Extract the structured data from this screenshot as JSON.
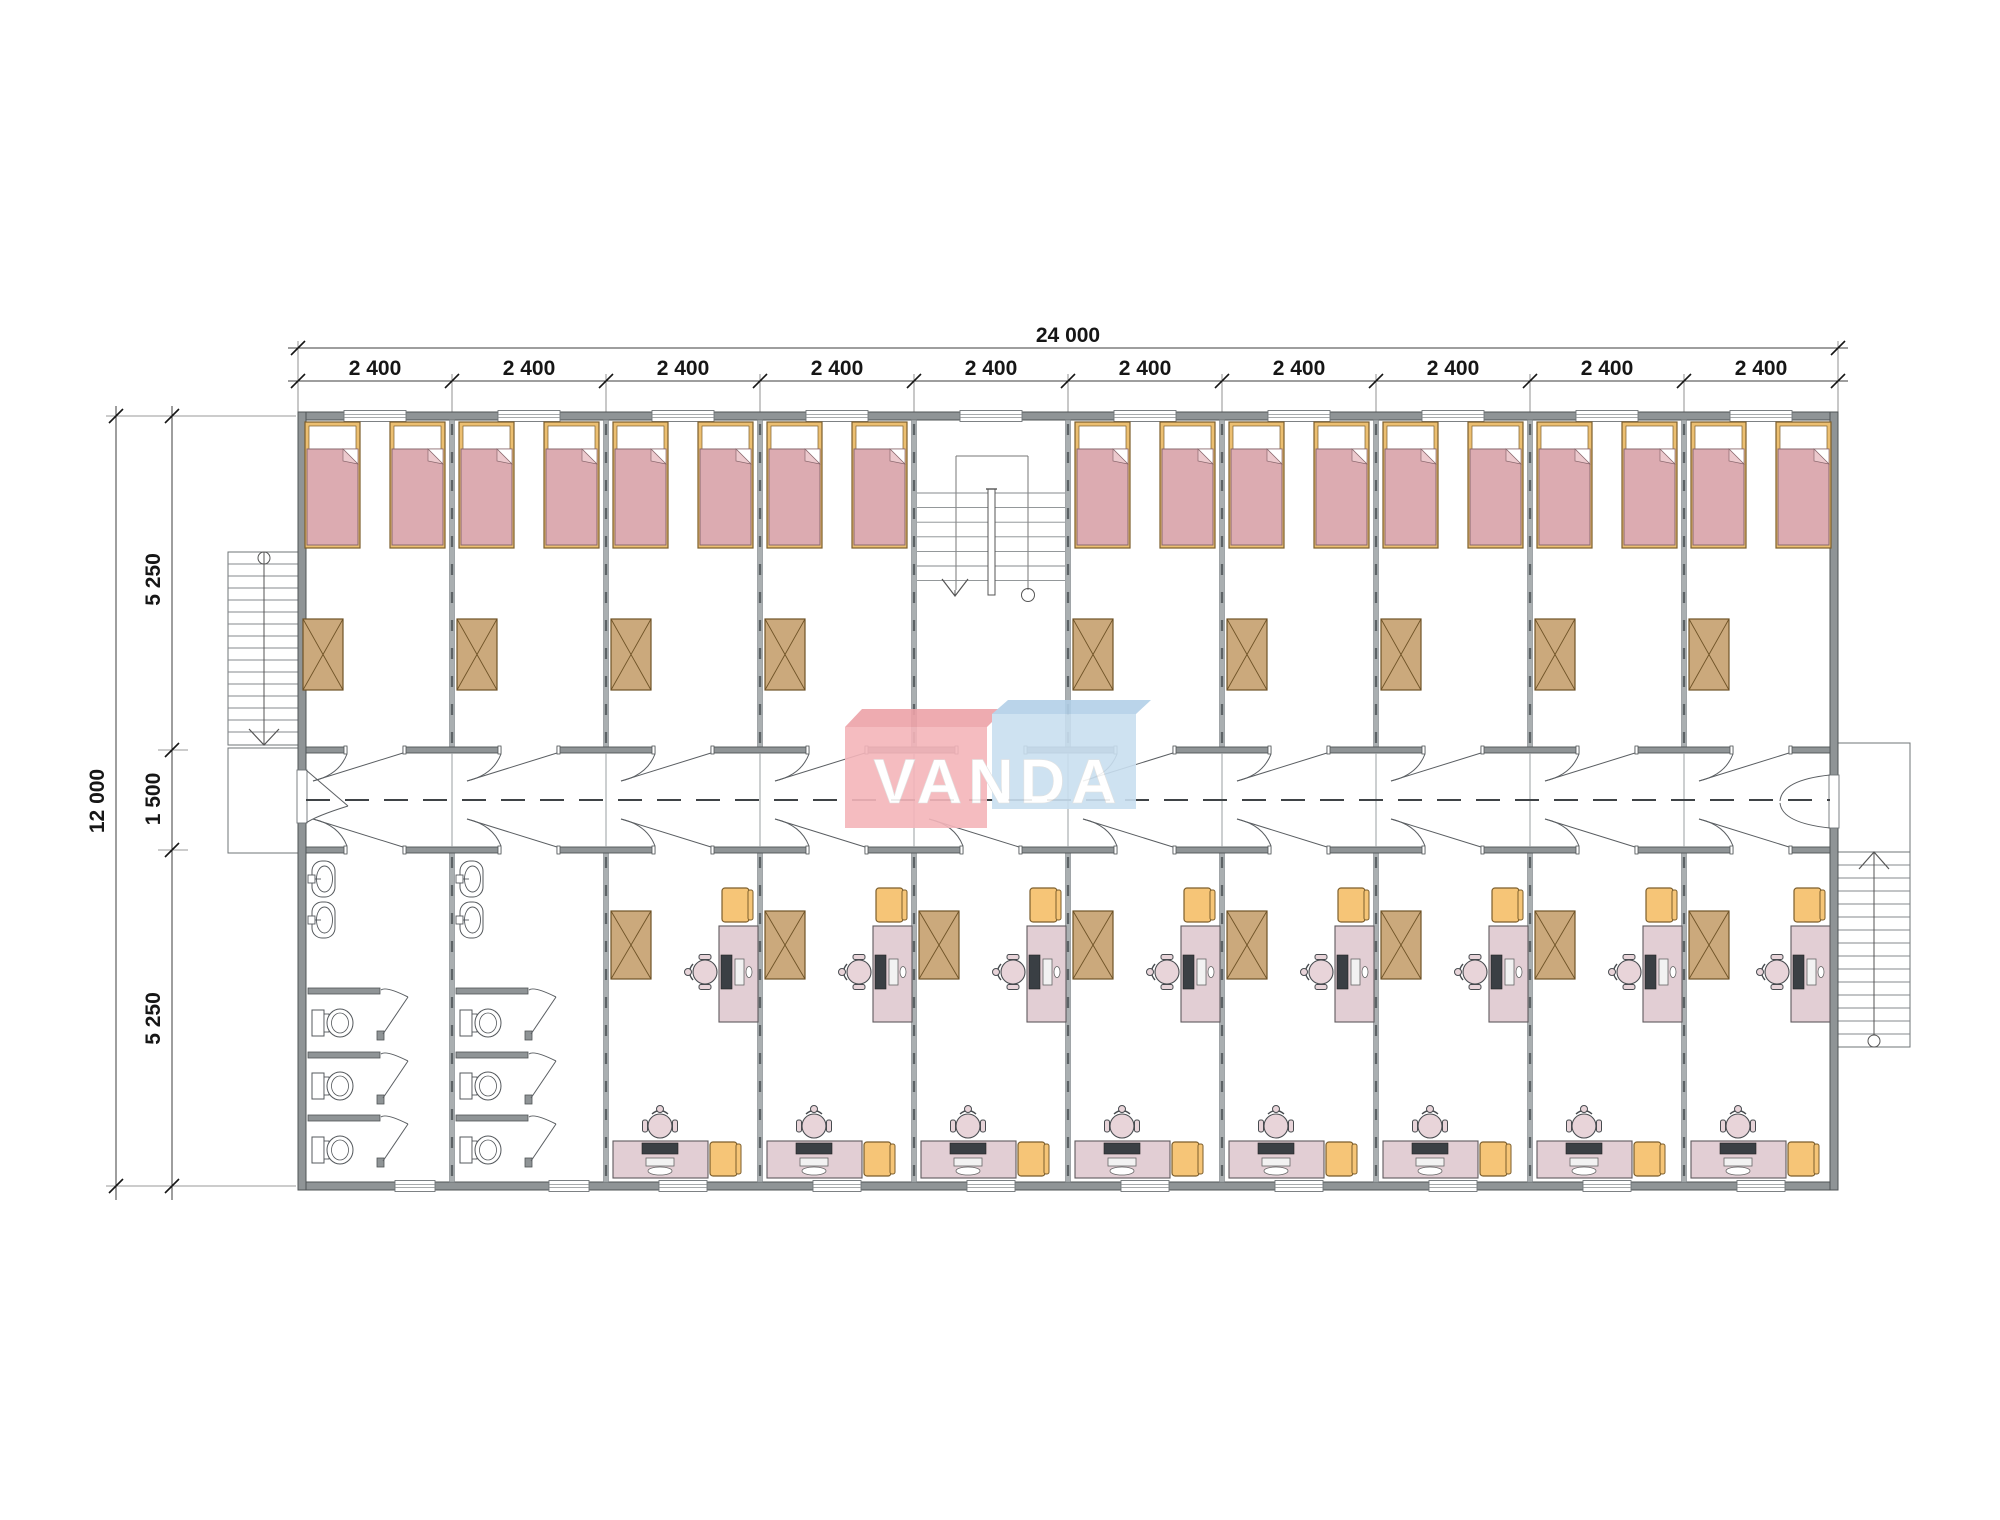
{
  "page": {
    "type": "architectural-floor-plan",
    "background": "#ffffff"
  },
  "logo": {
    "text": "VANDA",
    "pink_block": "#f4b5ba",
    "pink_block_top": "#eda2a8",
    "blue_block": "#c9dff0",
    "blue_block_top": "#b3d0e8",
    "text_color": "#ffffff"
  },
  "dimensions": {
    "total_width": "24 000",
    "bay_label": "2 400",
    "bay_count": 10,
    "total_height": "12 000",
    "segment_upper": "5 250",
    "segment_corridor": "1 500",
    "segment_lower": "5 250"
  },
  "building": {
    "bays": 10,
    "bay_width_mm": 2400,
    "total_width_mm": 24000,
    "total_height_mm": 12000,
    "corridor_width_mm": 1500,
    "room_depth_mm": 5250,
    "stair_bay_index": 5
  },
  "rooms": {
    "bedrooms": {
      "count": 9,
      "furniture_per_room": [
        "bed",
        "bed",
        "wardrobe"
      ],
      "windows_per_room": 1
    },
    "offices": {
      "count": 8,
      "furniture_per_room": [
        "wardrobe",
        "desk-with-computer",
        "office-chair",
        "armchair",
        "desk-with-computer",
        "office-chair",
        "armchair"
      ],
      "windows_per_room": 1
    },
    "bathrooms": {
      "count": 2,
      "fixtures_per_room": [
        "sink",
        "sink",
        "toilet-stall",
        "toilet-stall",
        "toilet-stall"
      ]
    }
  },
  "stairs": {
    "left_external": "exterior-stair-with-landing",
    "central": "double-run-stair",
    "right_external": "exterior-stair-with-landing"
  },
  "colors": {
    "wall": "#8f9496",
    "wallEdge": "#4f5456",
    "partition": "#aaafb1",
    "partitionEdge": "#7e8487",
    "partitionDash": "#5d6366",
    "bedFrame": "#ecbf71",
    "bedFrameEdge": "#7c5e2c",
    "blanket": "#dcabb1",
    "blanketEdge": "#8a686e",
    "blanketFold": "#ecc9cd",
    "wardrobe": "#cba97c",
    "wardrobeEdge": "#6f5327",
    "desk": "#e2ced4",
    "deskEdge": "#5f5a5e",
    "chairSeat": "#e8d4d9",
    "chairEdge": "#474b4f",
    "armchair": "#f6c577",
    "armchairEdge": "#7c5e2c",
    "monitor": "#3a3f44",
    "fixtureEdge": "#54585c",
    "stairLine": "#85898c",
    "stairEdge": "#6f7477",
    "dimLine": "#3c3c3c",
    "dimText": "#161616",
    "centerline": "#3f4346"
  }
}
